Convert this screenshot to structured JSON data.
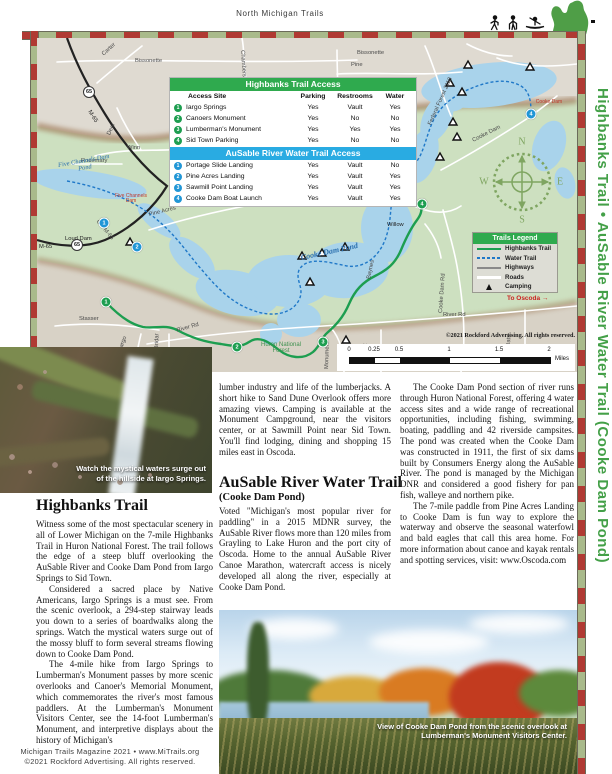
{
  "header": {
    "title": "North Michigan Trails",
    "icons": [
      "hiker-icon",
      "snowshoer-icon",
      "kayaker-icon",
      "michigan-state-icon"
    ]
  },
  "sidebar": {
    "title": "Highbanks Trail  •  AuSable River Water Trail (Cooke Dam Pond)",
    "color": "#44a048"
  },
  "colors": {
    "stripe_red": "#b03a33",
    "stripe_green": "#a9ba8b",
    "table_green": "#2faa4e",
    "table_blue": "#29abe2",
    "trail_green": "#1d9e50",
    "water_trail_blue": "#1f78c8",
    "water": "#a9d3eb"
  },
  "map": {
    "access_tables": [
      {
        "title": "Highbanks Trail Access",
        "columns": {
          "site": "Access Site",
          "parking": "Parking",
          "restrooms": "Restrooms",
          "water": "Water"
        },
        "rows": [
          {
            "n": "1",
            "site": "Iargo Springs",
            "parking": "Yes",
            "restrooms": "Vault",
            "water": "Yes"
          },
          {
            "n": "2",
            "site": "Canoers Monument",
            "parking": "Yes",
            "restrooms": "No",
            "water": "No"
          },
          {
            "n": "3",
            "site": "Lumberman's Monument",
            "parking": "Yes",
            "restrooms": "Yes",
            "water": "Yes"
          },
          {
            "n": "4",
            "site": "Sid Town Parking",
            "parking": "Yes",
            "restrooms": "No",
            "water": "No"
          }
        ]
      },
      {
        "title": "AuSable River Water Trail Access",
        "rows": [
          {
            "n": "1",
            "site": "Portage Slide Landing",
            "parking": "Yes",
            "restrooms": "Vault",
            "water": "No"
          },
          {
            "n": "2",
            "site": "Pine Acres Landing",
            "parking": "Yes",
            "restrooms": "Vault",
            "water": "Yes"
          },
          {
            "n": "3",
            "site": "Sawmill Point Landing",
            "parking": "Yes",
            "restrooms": "Vault",
            "water": "Yes"
          },
          {
            "n": "4",
            "site": "Cooke Dam Boat Launch",
            "parking": "Yes",
            "restrooms": "Vault",
            "water": "Yes"
          }
        ]
      }
    ],
    "legend": {
      "title": "Trails Legend",
      "items": [
        "Highbanks Trail",
        "Water Trail",
        "Highways",
        "Roads",
        "Camping"
      ]
    },
    "scale": {
      "ticks": [
        "0",
        "0.25",
        "0.5",
        "1",
        "1.5",
        "2"
      ],
      "unit": "Miles"
    },
    "copyright": "©2021 Rockford Advertising. All rights reserved.",
    "route_shield": "65",
    "compass": {
      "n": "N",
      "e": "E",
      "w": "W",
      "s": "S"
    },
    "to_oscoda": "To Oscoda →",
    "marker_numbers": {
      "green": [
        "1",
        "2",
        "3",
        "4"
      ],
      "blue": [
        "1",
        "2",
        "3",
        "4"
      ]
    },
    "labels": [
      "Carter",
      "Bissonette",
      "Bissonette",
      "Pine",
      "Chambers Rd",
      "McArdle Rd",
      "Federal Forest 2113",
      "Federal Forest 2118",
      "Winn",
      "Rosemary",
      "Deer",
      "M-65",
      "Five Channels Dam Pond",
      "Five Channels Dam",
      "Loud Dam",
      "M-65",
      "Old M-65",
      "Pine Acres",
      "Huron National Forest",
      "Huron National Forest",
      "Cooke Dam Pond",
      "Cooke Dam",
      "Cooke Dam",
      "Sid Town",
      "Willow",
      "Baynes",
      "Cooke Dam Rd",
      "Stasser",
      "Iargo",
      "Bridar",
      "River Rd",
      "River Rd",
      "Lorenz",
      "Monument",
      "Oats"
    ]
  },
  "articles": {
    "highbanks": {
      "heading": "Highbanks Trail",
      "p1": "Witness some of the most spectacular scenery in all of Lower Michigan on the 7-mile Highbanks Trail in Huron National Forest. The trail follows the edge of a steep bluff overlooking the AuSable River and Cooke Dam Pond from Iargo Springs to Sid Town.",
      "p2": "Considered a sacred place by Native Americans, Iargo Springs is a must see. From the scenic overlook, a 294-step stairway leads you down to a series of boardwalks along the springs. Watch the mystical waters surge out of the mossy bluff to form several streams flowing down to Cooke Dam Pond.",
      "p3": "The 4-mile hike from Iargo Springs to Lumberman's Monument passes by more scenic overlooks and Canoer's Memorial Monument, which commemorates the river's most famous paddlers. At the Lumberman's Monument Visitors Center, see the 14-foot Lumberman's Monument, and interpretive displays about the history of Michigan's",
      "p3_cont": "lumber industry and life of the lumberjacks. A short hike to Sand Dune Overlook offers more amazing views. Camping is available at the Monument Campground, near the visitors center, or at Sawmill Point near Sid Town. You'll find lodging, dining and shopping 15 miles east in Oscoda."
    },
    "ausable": {
      "heading": "AuSable River Water Trail",
      "subheading": "(Cooke Dam Pond)",
      "p1": "Voted \"Michigan's most popular river for paddling\" in a 2015 MDNR survey, the AuSable River flows more than 120 miles from Grayling to Lake Huron and the port city of Oscoda. Home to the annual AuSable River Canoe Marathon, watercraft access is nicely developed all along the river, especially at Cooke Dam Pond.",
      "p2": "The Cooke Dam Pond section of river runs through Huron National Forest, offering 4 water access sites and a wide range of recreational opportunities, including fishing, swimming, boating, paddling and 42 riverside campsites. The pond was created when the Cooke Dam was constructed in 1911, the first of six dams built by Consumers Energy along the AuSable River. The pond is managed by the Michigan DNR and considered a good fishery for pan fish, walleye and northern pike.",
      "p3": "The 7-mile paddle from Pine Acres Landing to Cooke Dam is fun way to explore the waterway and observe the seasonal waterfowl and bald eagles that call this area home. For more information about canoe and kayak rentals and spotting services, visit: www.Oscoda.com"
    }
  },
  "photos": {
    "iargo_caption": "Watch the mystical waters surge out of the hillside at Iargo Springs.",
    "pond_caption": "View of Cooke Dam Pond from the scenic overlook at Lumberman's Monument Visitors Center."
  },
  "footer": {
    "line1": "Michigan Trails Magazine 2021 • www.MiTrails.org",
    "line2": "©2021 Rockford Advertising. All rights reserved."
  }
}
